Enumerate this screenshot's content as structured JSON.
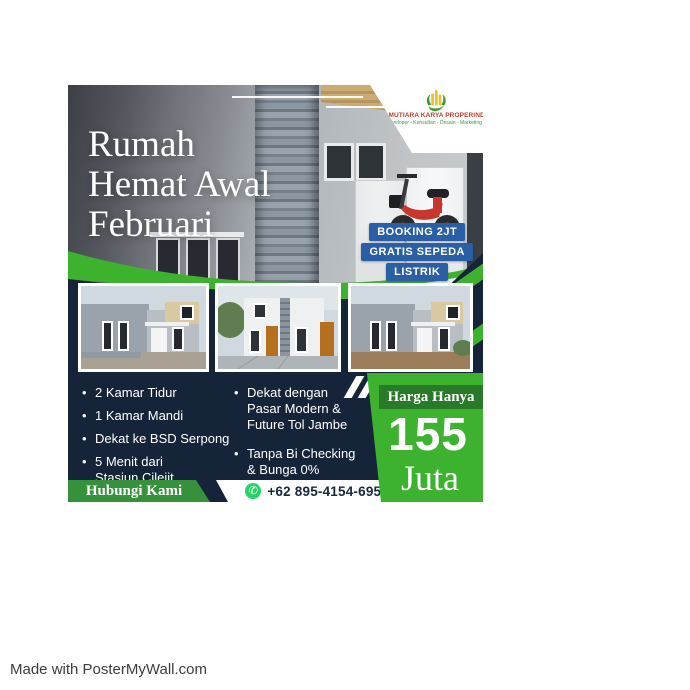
{
  "watermark": "Made with PosterMyWall.com",
  "poster": {
    "title": {
      "line1": "Rumah",
      "line2": "Hemat Awal",
      "line3": "Februari"
    },
    "logo": {
      "company": "PT MUTIARA KARYA PROPERINDO",
      "tagline": "Developer - Konsultan - Desain - Marketing",
      "icon": "building-leaves-logo"
    },
    "promo_badges": {
      "line1": "BOOKING 2JT",
      "line2": "GRATIS SEPEDA",
      "line3": "LISTRIK"
    },
    "features_left": [
      "2 Kamar Tidur",
      "1 Kamar Mandi",
      "Dekat ke BSD Serpong",
      "5 Menit dari\nStasiun Cilejit"
    ],
    "features_right": [
      "Dekat dengan\nPasar Modern &\nFuture Tol Jambe",
      "Tanpa Bi Checking\n& Bunga 0%"
    ],
    "contact": {
      "label": "Hubungi Kami",
      "phone": "+62 895-4154-69536"
    },
    "price": {
      "label": "Harga Hanya",
      "amount": "155",
      "unit": "Juta"
    },
    "colors": {
      "navy": "#16243A",
      "green": "#3CB22E",
      "dark_green": "#287A28",
      "contact_green": "#35913A",
      "badge_blue": "#2A5FA5",
      "whatsapp_green": "#25D366"
    }
  }
}
